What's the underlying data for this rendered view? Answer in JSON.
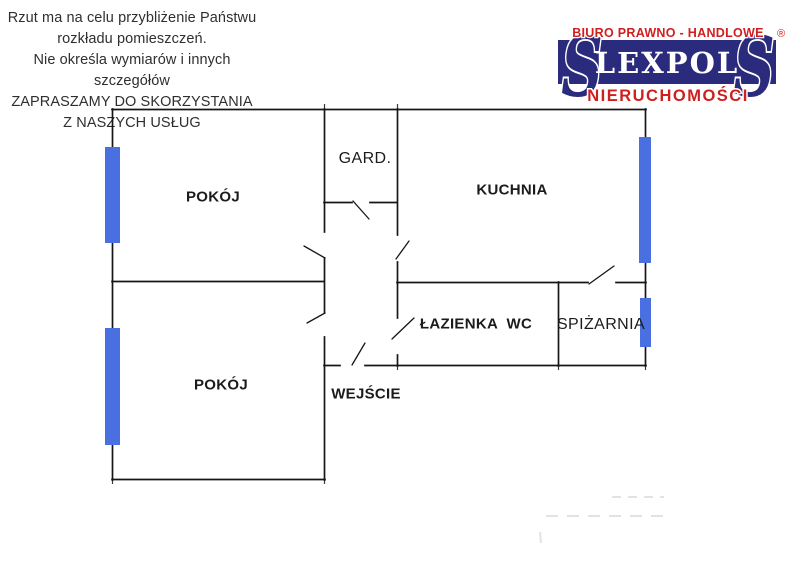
{
  "disclaimer": {
    "lines": [
      "Rzut ma na celu przybliżenie Państwu",
      "rozkładu pomieszczeń.",
      "Nie określa wymiarów i innych szczegółów",
      "ZAPRASZAMY DO SKORZYSTANIA",
      "Z NASZYCH USŁUG"
    ]
  },
  "logo": {
    "tagline_top": "BIURO PRAWNO - HANDLOWE",
    "registered_mark": "®",
    "brand": "LEXPOL",
    "tagline_bottom": "NIERUCHOMOŚCI",
    "ornament_s": "S",
    "colors": {
      "banner_navy": "#2b2b7d",
      "accent_red": "#d01f1f",
      "brand_white": "#ffffff"
    }
  },
  "floor_plan": {
    "rooms": [
      {
        "id": "pokoj-upper",
        "label": "POKÓJ"
      },
      {
        "id": "gard",
        "label": "GARD."
      },
      {
        "id": "kuchnia",
        "label": "KUCHNIA"
      },
      {
        "id": "lazienka-wc",
        "label": "ŁAZIENKA  WC"
      },
      {
        "id": "spizarnia",
        "label": "SPIŻARNIA"
      },
      {
        "id": "pokoj-lower",
        "label": "POKÓJ"
      },
      {
        "id": "wejscie",
        "label": "WEJŚCIE"
      }
    ],
    "colors": {
      "wall": "#161616",
      "window_blue": "#4a6fe0",
      "artifact_gray": "#e2e2e2"
    }
  }
}
